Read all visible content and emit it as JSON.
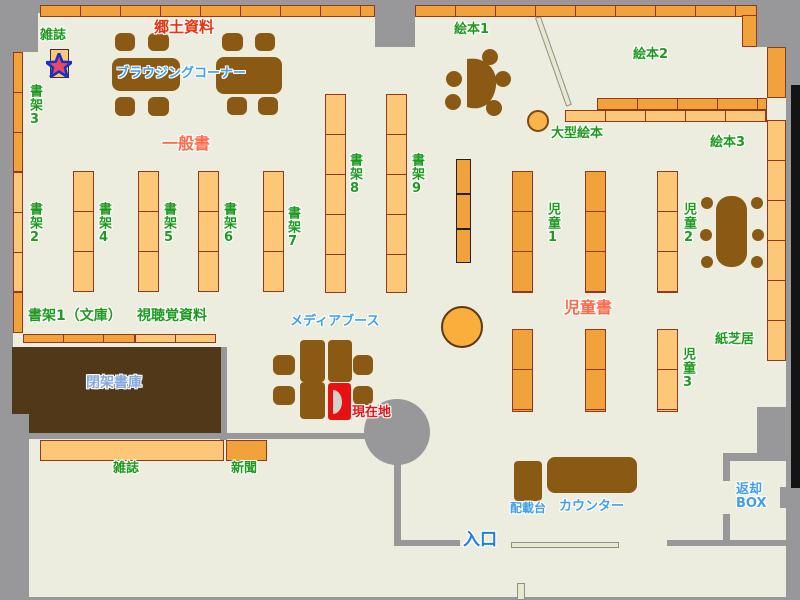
{
  "colors": {
    "floor": "#ECEDDF",
    "wall_gray": "#98989A",
    "shelf_light": "#FCC878",
    "shelf_dark": "#F2A23B",
    "shelf_border": "#8E3A20",
    "furniture_brown": "#8A5A15",
    "closed_stack_brown": "#503818",
    "label_green": "#1E9A1E",
    "label_red": "#E8330F",
    "label_orange": "#FB6B4B",
    "label_blue": "#3FA0E8",
    "label_lightblue": "#85A8DC",
    "current_location_red": "#E81010",
    "entrance_blue": "#1B7FE8",
    "star_fill": "#E84A64",
    "star_outline": "#1C30C8"
  },
  "labels": {
    "zasshi_top": "雑誌",
    "shoka3": "書架3",
    "shoka2": "書架2",
    "kyodo": "郷土資料",
    "browsing": "ブラウジングコーナー",
    "ippan": "一般書",
    "shoka4": "書架4",
    "shoka5": "書架5",
    "shoka6": "書架6",
    "shoka7": "書架7",
    "shoka8": "書架8",
    "shoka9": "書架9",
    "ehon1": "絵本1",
    "ehon2": "絵本2",
    "ehon3": "絵本3",
    "ogata": "大型絵本",
    "jido1": "児童1",
    "jido2": "児童2",
    "jido3": "児童3",
    "jidosho": "児童書",
    "kamishibai": "紙芝居",
    "shoka1_bunko": "書架1（文庫）",
    "shichokaku": "視聴覚資料",
    "media_booth": "メディアブース",
    "genzaichi": "現在地",
    "heika_shoko": "閉架書庫",
    "zasshi_bottom": "雑誌",
    "shinbun": "新聞",
    "haisai_dai": "配載台",
    "counter": "カウンター",
    "iriguchi": "入口",
    "henkyaku_box": "返却BOX"
  }
}
